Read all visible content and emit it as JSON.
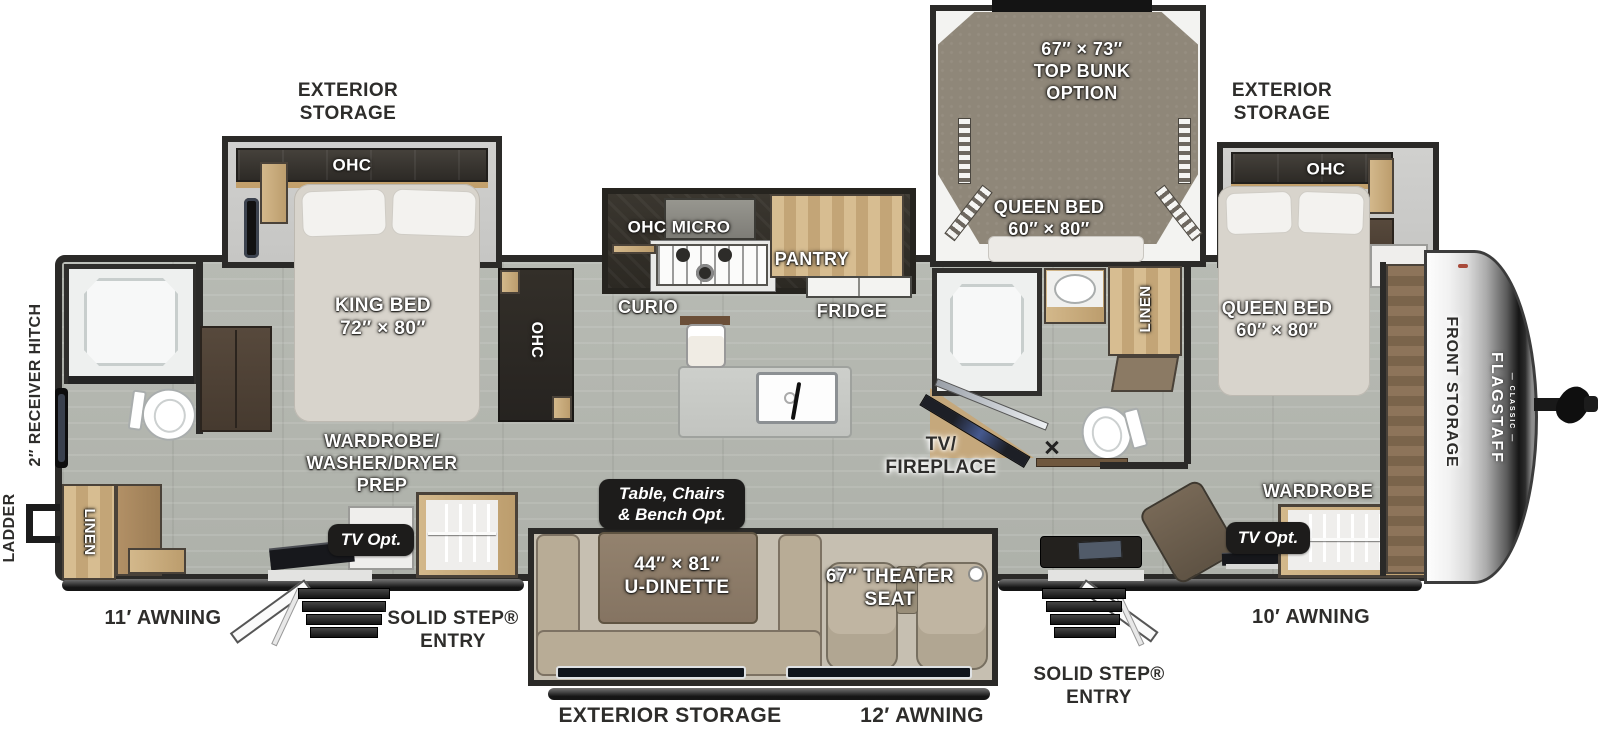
{
  "plan": {
    "brand": {
      "name": "FLAGSTAFF",
      "series": "— CLASSIC —"
    },
    "palette": {
      "wall": "#2b2a28",
      "floor": "#b7bab3",
      "wood": "#c9a87a",
      "carpet": "#8f8779",
      "badge_bg": "#1d1c1b",
      "label_dark": "#2e2d2b",
      "label_light": "#ffffff"
    },
    "exterior": {
      "storage_top_left": "EXTERIOR\nSTORAGE",
      "storage_top_right": "EXTERIOR\nSTORAGE",
      "storage_bottom": "EXTERIOR STORAGE",
      "awning_rear": "11′ AWNING",
      "awning_center": "12′ AWNING",
      "awning_front": "10′ AWNING",
      "entry_rear": "SOLID STEP®\nENTRY",
      "entry_front": "SOLID STEP®\nENTRY",
      "ladder": "LADDER",
      "receiver_hitch": "2″ RECEIVER HITCH",
      "front_storage": "FRONT STORAGE"
    },
    "rooms": {
      "rear_bedroom": {
        "king_bed": "KING BED\n72″ × 80″",
        "ohc": "OHC",
        "ohc_side": "OHC",
        "wardrobe_prep": "WARDROBE/\nWASHER/DRYER\nPREP",
        "tv_opt": "TV Opt.",
        "linen": "LINEN"
      },
      "kitchen": {
        "ohc_micro": "OHC  MICRO",
        "pantry": "PANTRY",
        "curio": "CURIO",
        "fridge": "FRIDGE"
      },
      "living": {
        "dinette_option": "Table, Chairs\n& Bench  Opt.",
        "dinette": "44″ × 81″\nU-DINETTE",
        "theater_seat": "67″ THEATER\nSEAT",
        "tv_fireplace": "TV/\nFIREPLACE"
      },
      "bunk_room": {
        "top_bunk": "67″ × 73″\nTOP BUNK\nOPTION",
        "queen_bed": "QUEEN BED\n60″ × 80″",
        "linen": "LINEN"
      },
      "front_bedroom": {
        "queen_bed": "QUEEN BED\n60″ × 80″",
        "ohc": "OHC",
        "wardrobe": "WARDROBE",
        "tv_opt": "TV Opt."
      }
    }
  }
}
